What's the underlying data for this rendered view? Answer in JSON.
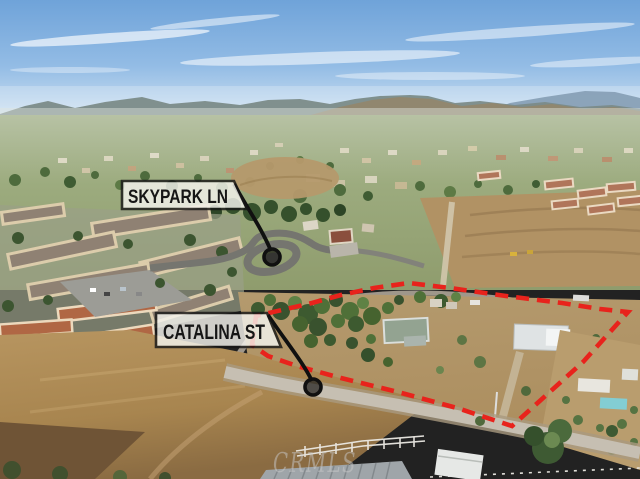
{
  "annotations": {
    "streets": [
      {
        "id": "skypark",
        "label": "SKYPARK LN"
      },
      {
        "id": "catalina",
        "label": "CATALINA ST"
      }
    ],
    "boundary_color": "#e8231c",
    "label_bg": "#f5f4ee",
    "label_border": "#171717",
    "label_text_color": "#161616",
    "pointer_color": "#101010"
  },
  "watermark": {
    "text": "CRMLS",
    "color": "#c9c9c9"
  }
}
